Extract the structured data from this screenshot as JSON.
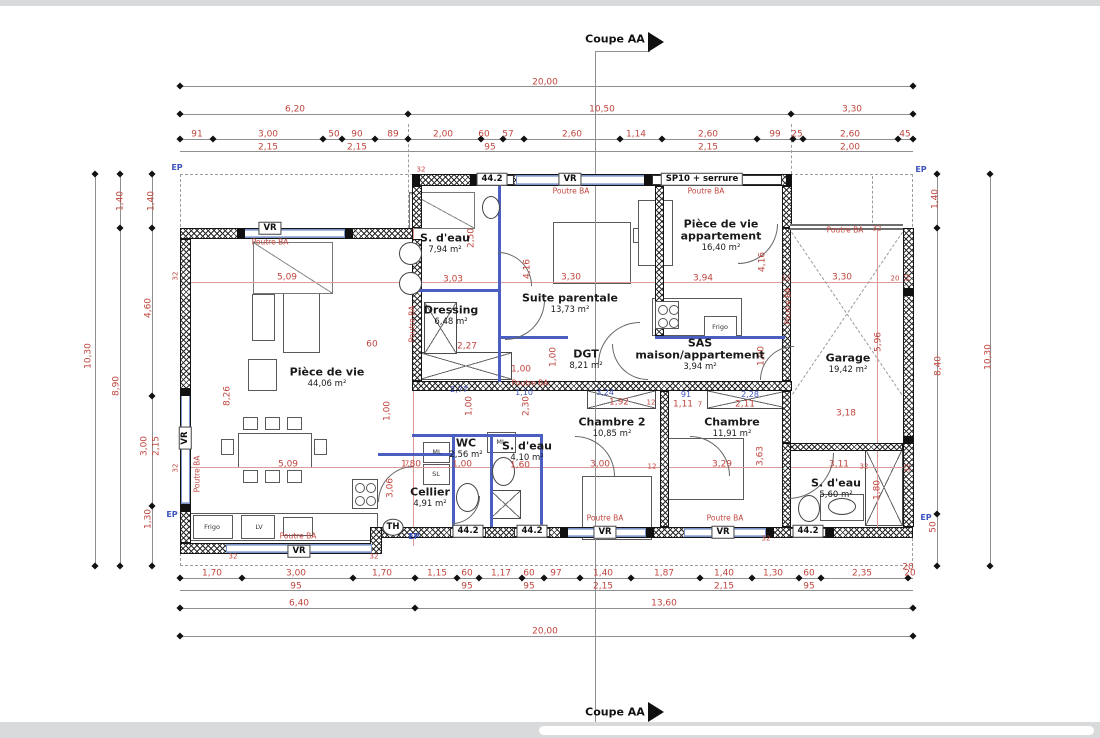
{
  "coupe": {
    "top": "Coupe AA",
    "bottom": "Coupe AA"
  },
  "colors": {
    "dimension_red": "#c0463f",
    "partition_blue": "#4a5fc0",
    "annotation_blue": "#3e55c0"
  },
  "rooms": [
    {
      "n": "room-piece-de-vie",
      "t": "Pièce de vie",
      "a": "44,06 m²",
      "x": 327,
      "y": 366
    },
    {
      "n": "room-s-eau-1",
      "t": "S. d'eau",
      "a": "7,94 m²",
      "x": 445,
      "y": 232
    },
    {
      "n": "room-dressing",
      "t": "Dressing",
      "a": "6,48 m²",
      "x": 451,
      "y": 304
    },
    {
      "n": "room-suite-parentale",
      "t": "Suite parentale",
      "a": "13,73 m²",
      "x": 570,
      "y": 292
    },
    {
      "n": "room-piece-de-vie-appartement",
      "t": "Pièce de vie",
      "t2": "appartement",
      "a": "16,40 m²",
      "x": 721,
      "y": 218
    },
    {
      "n": "room-dgt",
      "t": "DGT",
      "a": "8,21 m²",
      "x": 586,
      "y": 348
    },
    {
      "n": "room-sas",
      "t": "SAS",
      "t2": "maison/appartement",
      "a": "3,94 m²",
      "x": 700,
      "y": 337
    },
    {
      "n": "room-garage",
      "t": "Garage",
      "a": "19,42 m²",
      "x": 848,
      "y": 352
    },
    {
      "n": "room-chambre-2",
      "t": "Chambre 2",
      "a": "10,85 m²",
      "x": 612,
      "y": 416
    },
    {
      "n": "room-chambre",
      "t": "Chambre",
      "a": "11,91 m²",
      "x": 732,
      "y": 416
    },
    {
      "n": "room-wc",
      "t": "WC",
      "a": "2,56 m²",
      "x": 466,
      "y": 437
    },
    {
      "n": "room-s-eau-2",
      "t": "S. d'eau",
      "a": "4,10 m²",
      "x": 527,
      "y": 440
    },
    {
      "n": "room-cellier",
      "t": "Cellier",
      "a": "4,91 m²",
      "x": 430,
      "y": 486
    },
    {
      "n": "room-s-eau-3",
      "t": "S. d'eau",
      "a": "5,60 m²",
      "x": 836,
      "y": 477
    }
  ],
  "labels": {
    "dim": [
      {
        "t": "20,00",
        "x": 545,
        "y": 77
      },
      {
        "t": "6,20",
        "x": 295,
        "y": 104
      },
      {
        "t": "10,50",
        "x": 602,
        "y": 104
      },
      {
        "t": "3,30",
        "x": 852,
        "y": 104
      },
      {
        "t": "91",
        "x": 197,
        "y": 129
      },
      {
        "t": "3,00",
        "x": 268,
        "y": 129
      },
      {
        "t": "50",
        "x": 334,
        "y": 129
      },
      {
        "t": "90",
        "x": 357,
        "y": 129
      },
      {
        "t": "89",
        "x": 393,
        "y": 129
      },
      {
        "t": "2,00",
        "x": 443,
        "y": 129
      },
      {
        "t": "60",
        "x": 484,
        "y": 129
      },
      {
        "t": "57",
        "x": 508,
        "y": 129
      },
      {
        "t": "2,60",
        "x": 572,
        "y": 129
      },
      {
        "t": "1,14",
        "x": 636,
        "y": 129
      },
      {
        "t": "2,60",
        "x": 708,
        "y": 129
      },
      {
        "t": "99",
        "x": 775,
        "y": 129
      },
      {
        "t": "25",
        "x": 797,
        "y": 129
      },
      {
        "t": "2,60",
        "x": 850,
        "y": 129
      },
      {
        "t": "45",
        "x": 905,
        "y": 129
      },
      {
        "t": "2,15",
        "x": 268,
        "y": 142
      },
      {
        "t": "2,15",
        "x": 357,
        "y": 142
      },
      {
        "t": "95",
        "x": 490,
        "y": 142
      },
      {
        "t": "2,15",
        "x": 708,
        "y": 142
      },
      {
        "t": "2,00",
        "x": 850,
        "y": 142
      },
      {
        "t": "1,70",
        "x": 212,
        "y": 568
      },
      {
        "t": "3,00",
        "x": 296,
        "y": 568
      },
      {
        "t": "1,70",
        "x": 382,
        "y": 568
      },
      {
        "t": "1,15",
        "x": 437,
        "y": 568
      },
      {
        "t": "60",
        "x": 467,
        "y": 568
      },
      {
        "t": "1,17",
        "x": 501,
        "y": 568
      },
      {
        "t": "60",
        "x": 529,
        "y": 568
      },
      {
        "t": "97",
        "x": 556,
        "y": 568
      },
      {
        "t": "1,40",
        "x": 603,
        "y": 568
      },
      {
        "t": "1,87",
        "x": 664,
        "y": 568
      },
      {
        "t": "1,40",
        "x": 724,
        "y": 568
      },
      {
        "t": "1,30",
        "x": 773,
        "y": 568
      },
      {
        "t": "60",
        "x": 809,
        "y": 568
      },
      {
        "t": "2,35",
        "x": 862,
        "y": 568
      },
      {
        "t": "20",
        "x": 910,
        "y": 568
      },
      {
        "t": "95",
        "x": 296,
        "y": 581
      },
      {
        "t": "95",
        "x": 467,
        "y": 581
      },
      {
        "t": "95",
        "x": 529,
        "y": 581
      },
      {
        "t": "2,15",
        "x": 603,
        "y": 581
      },
      {
        "t": "2,15",
        "x": 724,
        "y": 581
      },
      {
        "t": "95",
        "x": 809,
        "y": 581
      },
      {
        "t": "6,40",
        "x": 299,
        "y": 598
      },
      {
        "t": "13,60",
        "x": 664,
        "y": 598
      },
      {
        "t": "20,00",
        "x": 545,
        "y": 626
      },
      {
        "t": "10,30",
        "x": 89,
        "y": 350,
        "r": 1
      },
      {
        "t": "1,40",
        "x": 121,
        "y": 195,
        "r": 1
      },
      {
        "t": "8,90",
        "x": 117,
        "y": 380,
        "r": 1
      },
      {
        "t": "1,40",
        "x": 152,
        "y": 195,
        "r": 1
      },
      {
        "t": "4,60",
        "x": 149,
        "y": 302,
        "r": 1
      },
      {
        "t": "3,00",
        "x": 145,
        "y": 440,
        "r": 1
      },
      {
        "t": "2,15",
        "x": 157,
        "y": 440,
        "r": 1
      },
      {
        "t": "1,30",
        "x": 149,
        "y": 513,
        "r": 1
      },
      {
        "t": "1,40",
        "x": 936,
        "y": 193,
        "r": 1
      },
      {
        "t": "8,40",
        "x": 939,
        "y": 360,
        "r": 1
      },
      {
        "t": "10,30",
        "x": 989,
        "y": 351,
        "r": 1
      },
      {
        "t": "50",
        "x": 934,
        "y": 521,
        "r": 1
      },
      {
        "t": "20",
        "x": 908,
        "y": 562
      },
      {
        "t": "5,09",
        "x": 287,
        "y": 272
      },
      {
        "t": "3,03",
        "x": 453,
        "y": 274
      },
      {
        "t": "3,30",
        "x": 571,
        "y": 272
      },
      {
        "t": "3,94",
        "x": 703,
        "y": 273
      },
      {
        "t": "3,30",
        "x": 842,
        "y": 272
      },
      {
        "t": "8,26",
        "x": 228,
        "y": 390,
        "r": 1
      },
      {
        "t": "4,16",
        "x": 528,
        "y": 263,
        "r": 1
      },
      {
        "t": "4,16",
        "x": 763,
        "y": 256,
        "r": 1
      },
      {
        "t": "2,50",
        "x": 472,
        "y": 232,
        "r": 1
      },
      {
        "t": "2,27",
        "x": 467,
        "y": 341
      },
      {
        "t": "1,00",
        "x": 521,
        "y": 364
      },
      {
        "t": "1,00",
        "x": 554,
        "y": 351,
        "r": 1
      },
      {
        "t": "60",
        "x": 372,
        "y": 339
      },
      {
        "t": "2,30",
        "x": 527,
        "y": 400,
        "r": 1
      },
      {
        "t": "1,00",
        "x": 470,
        "y": 400,
        "r": 1
      },
      {
        "t": "1,00",
        "x": 388,
        "y": 405,
        "r": 1
      },
      {
        "t": "3,06",
        "x": 391,
        "y": 482,
        "r": 1
      },
      {
        "t": "1,00",
        "x": 762,
        "y": 350,
        "r": 1
      },
      {
        "t": "5,09",
        "x": 288,
        "y": 459
      },
      {
        "t": "1,80",
        "x": 411,
        "y": 459
      },
      {
        "t": "1,00",
        "x": 462,
        "y": 459
      },
      {
        "t": "1,60",
        "x": 520,
        "y": 460
      },
      {
        "t": "3,00",
        "x": 600,
        "y": 459
      },
      {
        "t": "3,29",
        "x": 722,
        "y": 459
      },
      {
        "t": "3,11",
        "x": 839,
        "y": 459
      },
      {
        "t": "3,63",
        "x": 761,
        "y": 450,
        "r": 1
      },
      {
        "t": "1,80",
        "x": 878,
        "y": 484,
        "r": 1
      },
      {
        "t": "3,18",
        "x": 846,
        "y": 408
      },
      {
        "t": "5,96",
        "x": 879,
        "y": 336,
        "r": 1
      },
      {
        "t": "1,92",
        "x": 619,
        "y": 397
      },
      {
        "t": "1,11",
        "x": 683,
        "y": 399
      },
      {
        "t": "2,11",
        "x": 745,
        "y": 399
      }
    ],
    "dim_small": [
      {
        "t": "32",
        "x": 176,
        "y": 270,
        "r": 1
      },
      {
        "t": "32",
        "x": 176,
        "y": 462,
        "r": 1
      },
      {
        "t": "32",
        "x": 908,
        "y": 272,
        "r": 1
      },
      {
        "t": "32",
        "x": 908,
        "y": 462,
        "r": 1
      },
      {
        "t": "32",
        "x": 877,
        "y": 223
      },
      {
        "t": "32",
        "x": 421,
        "y": 164
      },
      {
        "t": "32",
        "x": 766,
        "y": 533
      },
      {
        "t": "32",
        "x": 233,
        "y": 551
      },
      {
        "t": "32",
        "x": 374,
        "y": 551
      },
      {
        "t": "32",
        "x": 864,
        "y": 461
      },
      {
        "t": "12",
        "x": 652,
        "y": 461
      },
      {
        "t": "12",
        "x": 651,
        "y": 397
      },
      {
        "t": "12",
        "x": 786,
        "y": 273
      },
      {
        "t": "20",
        "x": 895,
        "y": 273
      },
      {
        "t": "7",
        "x": 407,
        "y": 458
      },
      {
        "t": "7",
        "x": 700,
        "y": 399
      }
    ],
    "dim_blue": [
      {
        "t": "2,77",
        "x": 459,
        "y": 384
      },
      {
        "t": "1,10",
        "x": 524,
        "y": 387
      },
      {
        "t": "3,24",
        "x": 605,
        "y": 387
      },
      {
        "t": "91",
        "x": 686,
        "y": 389
      },
      {
        "t": "2,28",
        "x": 750,
        "y": 389
      }
    ],
    "beam_notes": [
      {
        "t": "Poutre BA",
        "x": 270,
        "y": 236
      },
      {
        "t": "Poutre BA",
        "x": 571,
        "y": 185
      },
      {
        "t": "Poutre BA",
        "x": 706,
        "y": 185
      },
      {
        "t": "Poutre BA",
        "x": 845,
        "y": 224
      },
      {
        "t": "Poutre BA",
        "x": 530,
        "y": 377
      },
      {
        "t": "Poutre BA",
        "x": 605,
        "y": 512
      },
      {
        "t": "Poutre BA",
        "x": 725,
        "y": 512
      },
      {
        "t": "Poutre BA",
        "x": 298,
        "y": 530
      },
      {
        "t": "Poutre BA",
        "x": 197,
        "y": 468,
        "r": 1
      },
      {
        "t": "Poutre BA",
        "x": 412,
        "y": 318,
        "r": 1
      },
      {
        "t": "Poutre BA",
        "x": 788,
        "y": 300,
        "r": 1
      }
    ],
    "openings": [
      {
        "t": "44.2",
        "x": 492,
        "y": 173
      },
      {
        "t": "VR",
        "x": 570,
        "y": 173
      },
      {
        "t": "SP10 + serrure",
        "x": 702,
        "y": 173,
        "n": "door-sp10-serrure-tag"
      },
      {
        "t": "VR",
        "x": 270,
        "y": 222
      },
      {
        "t": "VR",
        "x": 185,
        "y": 432,
        "r": 1
      },
      {
        "t": "VR",
        "x": 299,
        "y": 545
      },
      {
        "t": "44.2",
        "x": 468,
        "y": 525
      },
      {
        "t": "44.2",
        "x": 532,
        "y": 525
      },
      {
        "t": "VR",
        "x": 605,
        "y": 526
      },
      {
        "t": "VR",
        "x": 723,
        "y": 526
      },
      {
        "t": "44.2",
        "x": 808,
        "y": 525
      },
      {
        "t": "TH",
        "x": 393,
        "y": 521,
        "n": "thermostat-tag",
        "round": 1
      }
    ],
    "ep": [
      {
        "t": "EP",
        "x": 177,
        "y": 162
      },
      {
        "t": "EP",
        "x": 921,
        "y": 164
      },
      {
        "t": "EP",
        "x": 172,
        "y": 509
      },
      {
        "t": "EP",
        "x": 926,
        "y": 512
      },
      {
        "t": "EP",
        "x": 414,
        "y": 531
      }
    ],
    "appliances": [
      {
        "t": "Frigo",
        "x": 212,
        "y": 521
      },
      {
        "t": "LV",
        "x": 259,
        "y": 521
      },
      {
        "t": "Frigo",
        "x": 720,
        "y": 321
      },
      {
        "t": "ML",
        "x": 437,
        "y": 446
      },
      {
        "t": "SL",
        "x": 436,
        "y": 468
      },
      {
        "t": "ML",
        "x": 501,
        "y": 436
      }
    ]
  }
}
